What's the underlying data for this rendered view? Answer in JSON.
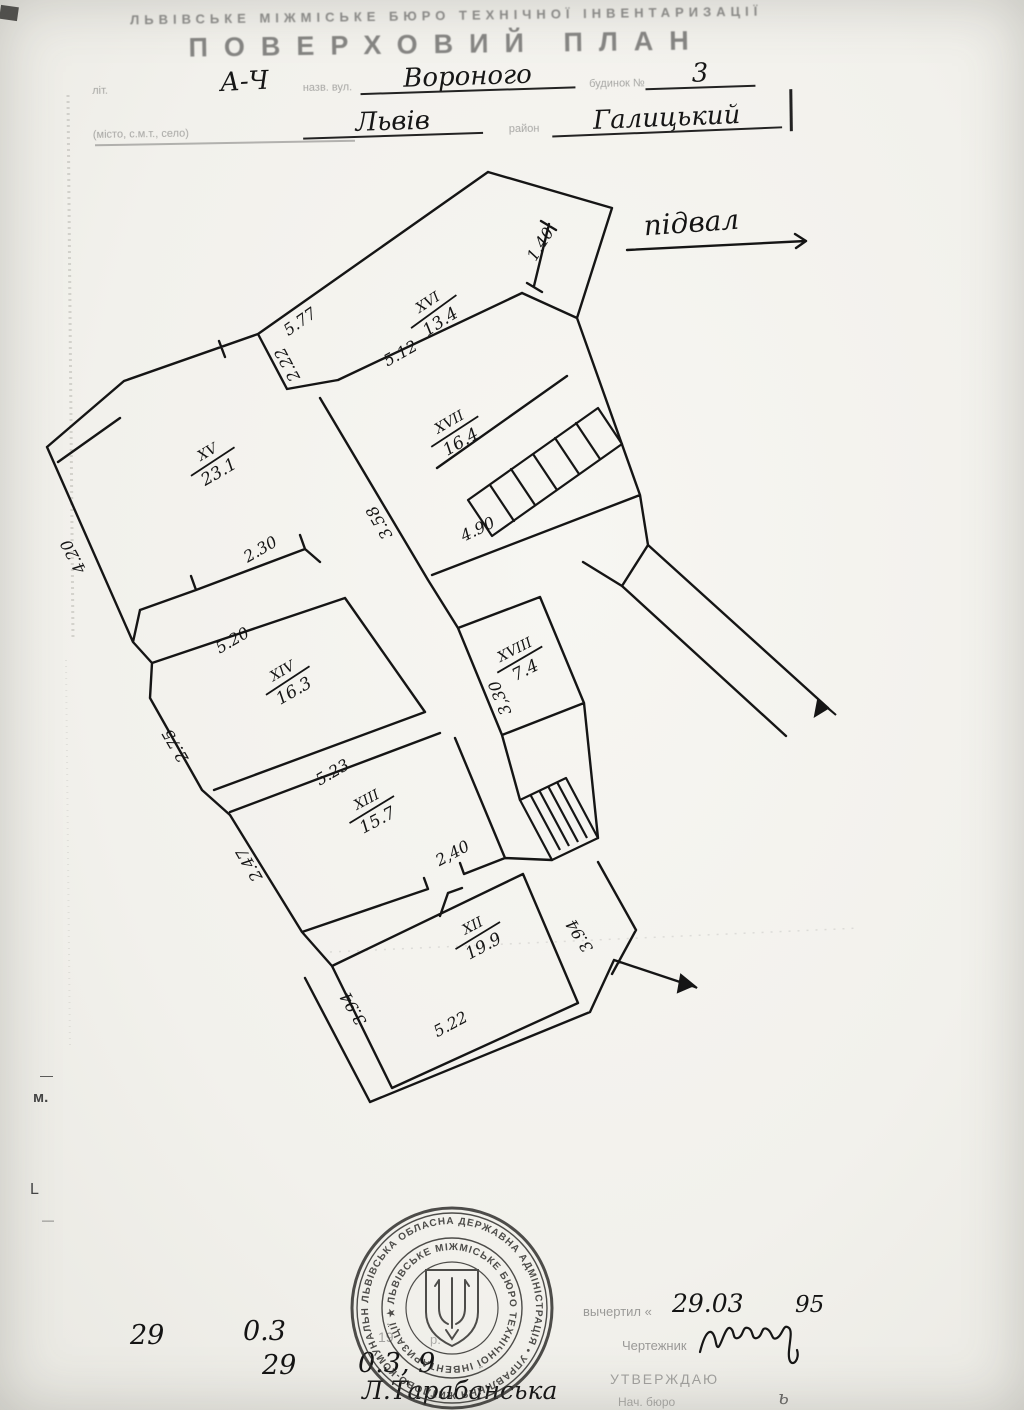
{
  "header": {
    "org_line": "ЛЬВІВСЬКЕ МІЖМІСЬКЕ БЮРО ТЕХНІЧНОЇ ІНВЕНТАРИЗАЦІЇ",
    "title": "ПОВЕРХОВИЙ ПЛАН",
    "row1": {
      "label1": "літ.",
      "lit": "А-Ч",
      "label2": "назв. вул.",
      "street": "Вороного",
      "label3": "будинок №",
      "number": "3"
    },
    "row2": {
      "label1": "(місто, с.м.т., село)",
      "city": "Львів",
      "label2": "район",
      "district": "Галицький"
    }
  },
  "plan": {
    "floor_label": "підвал",
    "rooms": [
      {
        "number": "XVI",
        "area": "13.4"
      },
      {
        "number": "XVII",
        "area": "16.4"
      },
      {
        "number": "XV",
        "area": "23.1"
      },
      {
        "number": "XVIII",
        "area": "7.4"
      },
      {
        "number": "XIV",
        "area": "16.3"
      },
      {
        "number": "XIII",
        "area": "15.7"
      },
      {
        "number": "XII",
        "area": "19.9"
      }
    ],
    "dimensions": [
      "5.77",
      "1.40",
      "5.12",
      "2.22",
      "3.58",
      "4.90",
      "2.30",
      "4.20",
      "5.20",
      "2.75",
      "5.23",
      "2.47",
      "2,40",
      "3,30",
      "3.94",
      "5.22",
      "3.94"
    ]
  },
  "footer": {
    "left": {
      "day1": "29",
      "month1": "0.3",
      "year_print": "19",
      "year_suffix": "р.",
      "day2": "29",
      "rest2": "0.3, 9",
      "name": "Л.Тарабанська"
    },
    "right": {
      "drawn_label": "вычертил «",
      "date": "29.03",
      "year": "95",
      "draftsman_label": "Чертежник",
      "approve_label": "УТВЕРЖДАЮ",
      "chief_label": "Нач. бюро",
      "chief_sig": "ь"
    }
  },
  "stamp": {
    "outer_text": "ЛЬВІВСЬКА ОБЛАСНА ДЕРЖАВНА АДМІНІСТРАЦІЯ • УПРАВЛІННЯ ЖИТЛОВО-КОМУНАЛЬНОГО ГОСПОДАРСТВА",
    "inner_text": "ЛЬВІВСЬКЕ  МІЖМІСЬКЕ  БЮРО  ТЕХНІЧНОЇ  ІНВЕНТАРИЗАЦІЇ  ★"
  },
  "margin": {
    "dash1": "—",
    "mark_m": "м.",
    "mark_l": "L",
    "dash2": "—"
  }
}
